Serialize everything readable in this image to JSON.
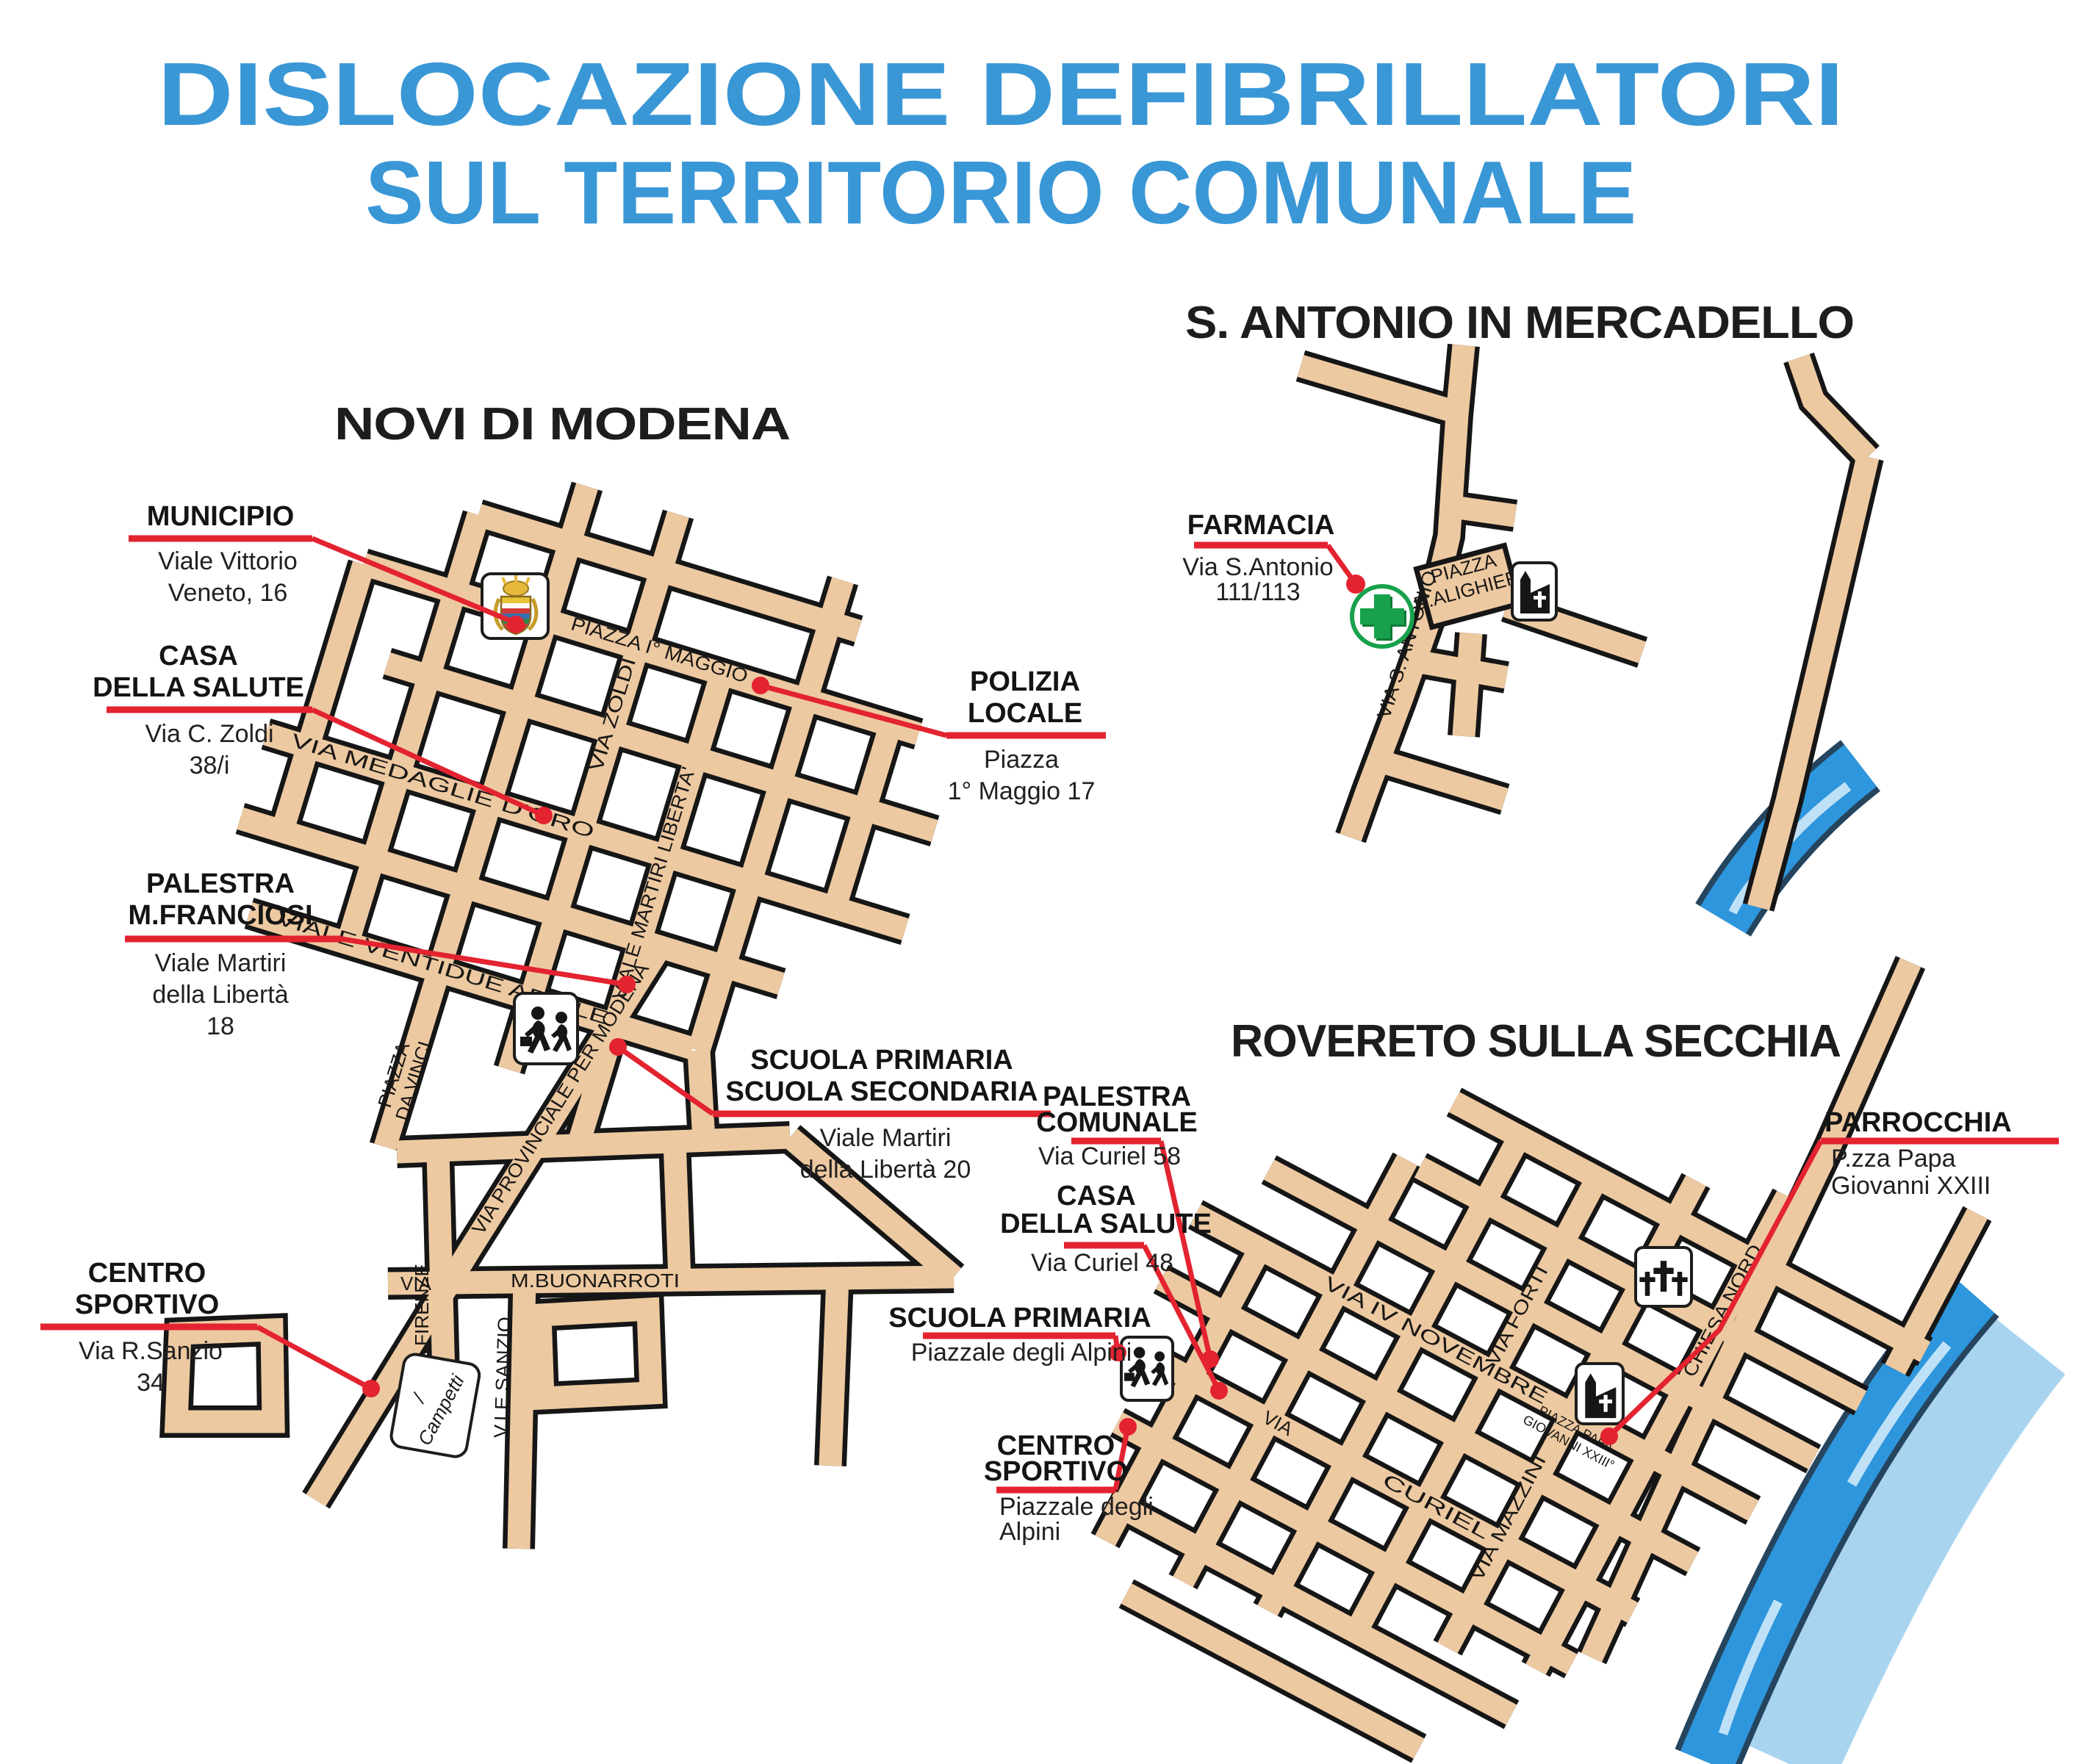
{
  "page_title": {
    "line1": "DISLOCAZIONE DEFIBRILLATORI",
    "line2": "SUL TERRITORIO COMUNALE"
  },
  "colors": {
    "title_blue": "#3a97d6",
    "callout_red": "#e32330",
    "road_fill": "#edc9a1",
    "road_casing": "#161616",
    "river_blue": "#2e96dd",
    "pharmacy_green": "#18a14c"
  },
  "maps": {
    "novi": {
      "title": "NOVI DI MODENA",
      "streets": {
        "medaglie": "VIA MEDAGLIE D'ORO",
        "zoldi": "VIA ZOLDI",
        "piazza_maggio": "PIAZZA I° MAGGIO",
        "ventidue": "VIALE VENTIDUE APRILE",
        "martiri": "VIALE MARTIRI LIBERTA'",
        "provinciale": "VIA PROVINCIALE PER MODENA",
        "da_vinci_1": "PIAZZA",
        "da_vinci_2": "DA VINCI",
        "via_label": "VIA",
        "buonarroti": "M.BUONARROTI",
        "firenze": "VIA FIRENZE",
        "sanzio": "V.LE SANZIO",
        "campetti_slash": "/",
        "campetti": "Campetti"
      },
      "sites": [
        {
          "id": "municipio",
          "name1": "MUNICIPIO",
          "addr1": "Viale Vittorio",
          "addr2": "Veneto, 16"
        },
        {
          "id": "casa-della-salute",
          "name1": "CASA",
          "name2": "DELLA SALUTE",
          "addr1": "Via C. Zoldi",
          "addr2": "38/i"
        },
        {
          "id": "palestra-franciosi",
          "name1": "PALESTRA",
          "name2": "M.FRANCIOSI",
          "addr1": "Viale Martiri",
          "addr2": "della Libertà",
          "addr3": "18"
        },
        {
          "id": "centro-sportivo",
          "name1": "CENTRO",
          "name2": "SPORTIVO",
          "addr1": "Via R.Sanzio",
          "addr2": "34"
        },
        {
          "id": "polizia-locale",
          "name1": "POLIZIA",
          "name2": "LOCALE",
          "addr1": "Piazza",
          "addr2": "1° Maggio 17"
        },
        {
          "id": "scuole",
          "name1": "SCUOLA PRIMARIA",
          "name2": "SCUOLA SECONDARIA",
          "addr1": "Viale Martiri",
          "addr2": "della Libertà 20"
        }
      ]
    },
    "mercadello": {
      "title": "S. ANTONIO IN MERCADELLO",
      "streets": {
        "piazza_alighieri_1": "PIAZZA",
        "piazza_alighieri_2": "D.ALIGHIERI",
        "via_s_antonio": "VIA S. ANTONIO"
      },
      "sites": [
        {
          "id": "farmacia",
          "name1": "FARMACIA",
          "addr1": "Via S.Antonio",
          "addr2": "111/113"
        }
      ]
    },
    "rovereto": {
      "title": "ROVERETO SULLA SECCHIA",
      "streets": {
        "iv_novembre": "VIA IV NOVEMBRE",
        "via_label": "VIA",
        "curiel": "CURIEL",
        "mazzini": "VIA MAZZINI",
        "forti": "VIA FORTI",
        "chiesa_nord": "CHIESA NORD",
        "pzza_papa_1": "PIAZZA PAPA",
        "pzza_papa_2": "GIOVANNI XXIII°"
      },
      "sites": [
        {
          "id": "palestra-comunale",
          "name1": "PALESTRA",
          "name2": "COMUNALE",
          "addr1": "Via Curiel 58"
        },
        {
          "id": "casa-della-salute",
          "name1": "CASA",
          "name2": "DELLA SALUTE",
          "addr1": "Via Curiel 48"
        },
        {
          "id": "scuola-primaria",
          "name1": "SCUOLA PRIMARIA",
          "addr1": "Piazzale degli Alpini"
        },
        {
          "id": "centro-sportivo",
          "name1": "CENTRO",
          "name2": "SPORTIVO",
          "addr1": "Piazzale degli",
          "addr2": "Alpini"
        },
        {
          "id": "parrocchia",
          "name1": "PARROCCHIA",
          "addr1": "P.zza Papa",
          "addr2": "Giovanni XXIII"
        }
      ]
    }
  }
}
